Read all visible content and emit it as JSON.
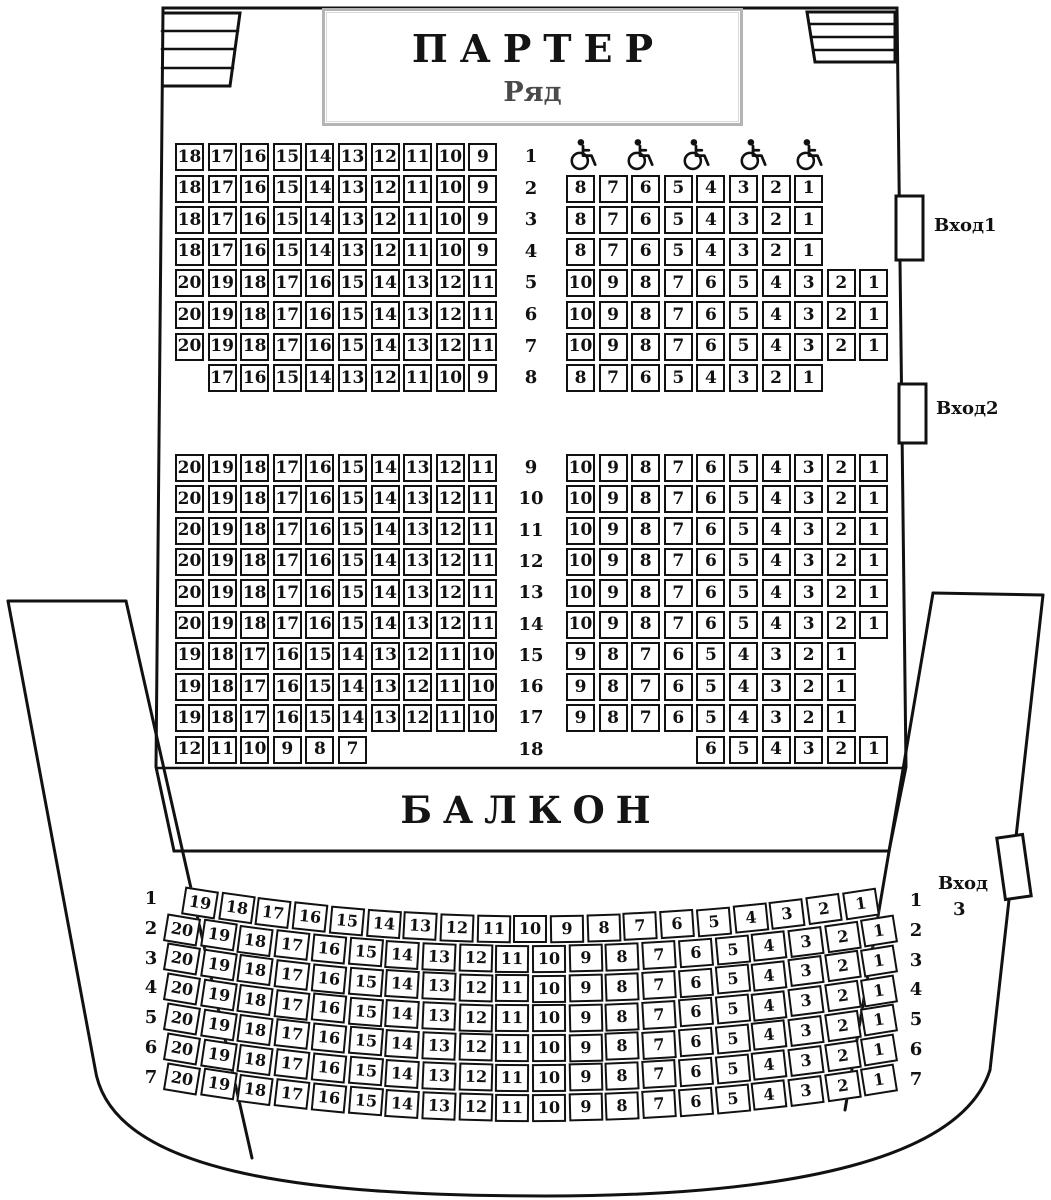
{
  "parterre": {
    "title": "ПАРТЕР",
    "subtitle": "Ряд",
    "rows": [
      {
        "n": "1",
        "left": [
          18,
          17,
          16,
          15,
          14,
          13,
          12,
          11,
          10,
          9
        ],
        "leftStart": 0,
        "wheelchairs": 5
      },
      {
        "n": "2",
        "left": [
          18,
          17,
          16,
          15,
          14,
          13,
          12,
          11,
          10,
          9
        ],
        "leftStart": 0,
        "right": [
          8,
          7,
          6,
          5,
          4,
          3,
          2,
          1
        ],
        "rightStart": 0
      },
      {
        "n": "3",
        "left": [
          18,
          17,
          16,
          15,
          14,
          13,
          12,
          11,
          10,
          9
        ],
        "leftStart": 0,
        "right": [
          8,
          7,
          6,
          5,
          4,
          3,
          2,
          1
        ],
        "rightStart": 0
      },
      {
        "n": "4",
        "left": [
          18,
          17,
          16,
          15,
          14,
          13,
          12,
          11,
          10,
          9
        ],
        "leftStart": 0,
        "right": [
          8,
          7,
          6,
          5,
          4,
          3,
          2,
          1
        ],
        "rightStart": 0
      },
      {
        "n": "5",
        "left": [
          20,
          19,
          18,
          17,
          16,
          15,
          14,
          13,
          12,
          11
        ],
        "leftStart": 0,
        "right": [
          10,
          9,
          8,
          7,
          6,
          5,
          4,
          3,
          2,
          1
        ],
        "rightStart": 0
      },
      {
        "n": "6",
        "left": [
          20,
          19,
          18,
          17,
          16,
          15,
          14,
          13,
          12,
          11
        ],
        "leftStart": 0,
        "right": [
          10,
          9,
          8,
          7,
          6,
          5,
          4,
          3,
          2,
          1
        ],
        "rightStart": 0
      },
      {
        "n": "7",
        "left": [
          20,
          19,
          18,
          17,
          16,
          15,
          14,
          13,
          12,
          11
        ],
        "leftStart": 0,
        "right": [
          10,
          9,
          8,
          7,
          6,
          5,
          4,
          3,
          2,
          1
        ],
        "rightStart": 0
      },
      {
        "n": "8",
        "left": [
          17,
          16,
          15,
          14,
          13,
          12,
          11,
          10,
          9
        ],
        "leftStart": 1,
        "right": [
          8,
          7,
          6,
          5,
          4,
          3,
          2,
          1
        ],
        "rightStart": 0
      },
      {
        "n": "9",
        "left": [
          20,
          19,
          18,
          17,
          16,
          15,
          14,
          13,
          12,
          11
        ],
        "leftStart": 0,
        "right": [
          10,
          9,
          8,
          7,
          6,
          5,
          4,
          3,
          2,
          1
        ],
        "rightStart": 0
      },
      {
        "n": "10",
        "left": [
          20,
          19,
          18,
          17,
          16,
          15,
          14,
          13,
          12,
          11
        ],
        "leftStart": 0,
        "right": [
          10,
          9,
          8,
          7,
          6,
          5,
          4,
          3,
          2,
          1
        ],
        "rightStart": 0
      },
      {
        "n": "11",
        "left": [
          20,
          19,
          18,
          17,
          16,
          15,
          14,
          13,
          12,
          11
        ],
        "leftStart": 0,
        "right": [
          10,
          9,
          8,
          7,
          6,
          5,
          4,
          3,
          2,
          1
        ],
        "rightStart": 0
      },
      {
        "n": "12",
        "left": [
          20,
          19,
          18,
          17,
          16,
          15,
          14,
          13,
          12,
          11
        ],
        "leftStart": 0,
        "right": [
          10,
          9,
          8,
          7,
          6,
          5,
          4,
          3,
          2,
          1
        ],
        "rightStart": 0
      },
      {
        "n": "13",
        "left": [
          20,
          19,
          18,
          17,
          16,
          15,
          14,
          13,
          12,
          11
        ],
        "leftStart": 0,
        "right": [
          10,
          9,
          8,
          7,
          6,
          5,
          4,
          3,
          2,
          1
        ],
        "rightStart": 0
      },
      {
        "n": "14",
        "left": [
          20,
          19,
          18,
          17,
          16,
          15,
          14,
          13,
          12,
          11
        ],
        "leftStart": 0,
        "right": [
          10,
          9,
          8,
          7,
          6,
          5,
          4,
          3,
          2,
          1
        ],
        "rightStart": 0
      },
      {
        "n": "15",
        "left": [
          19,
          18,
          17,
          16,
          15,
          14,
          13,
          12,
          11,
          10
        ],
        "leftStart": 0,
        "right": [
          9,
          8,
          7,
          6,
          5,
          4,
          3,
          2,
          1
        ],
        "rightStart": 0
      },
      {
        "n": "16",
        "left": [
          19,
          18,
          17,
          16,
          15,
          14,
          13,
          12,
          11,
          10
        ],
        "leftStart": 0,
        "right": [
          9,
          8,
          7,
          6,
          5,
          4,
          3,
          2,
          1
        ],
        "rightStart": 0
      },
      {
        "n": "17",
        "left": [
          19,
          18,
          17,
          16,
          15,
          14,
          13,
          12,
          11,
          10
        ],
        "leftStart": 0,
        "right": [
          9,
          8,
          7,
          6,
          5,
          4,
          3,
          2,
          1
        ],
        "rightStart": 0
      },
      {
        "n": "18",
        "left": [
          12,
          11,
          10,
          9,
          8,
          7
        ],
        "leftStart": 0,
        "right": [
          6,
          5,
          4,
          3,
          2,
          1
        ],
        "rightStart": 4
      }
    ]
  },
  "balcony": {
    "title": "БАЛКОН",
    "rows": [
      {
        "n": "1",
        "seats": [
          19,
          18,
          17,
          16,
          15,
          14,
          13,
          12,
          11,
          10,
          9,
          8,
          7,
          6,
          5,
          4,
          3,
          2,
          1
        ]
      },
      {
        "n": "2",
        "seats": [
          20,
          19,
          18,
          17,
          16,
          15,
          14,
          13,
          12,
          11,
          10,
          9,
          8,
          7,
          6,
          5,
          4,
          3,
          2,
          1
        ]
      },
      {
        "n": "3",
        "seats": [
          20,
          19,
          18,
          17,
          16,
          15,
          14,
          13,
          12,
          11,
          10,
          9,
          8,
          7,
          6,
          5,
          4,
          3,
          2,
          1
        ]
      },
      {
        "n": "4",
        "seats": [
          20,
          19,
          18,
          17,
          16,
          15,
          14,
          13,
          12,
          11,
          10,
          9,
          8,
          7,
          6,
          5,
          4,
          3,
          2,
          1
        ]
      },
      {
        "n": "5",
        "seats": [
          20,
          19,
          18,
          17,
          16,
          15,
          14,
          13,
          12,
          11,
          10,
          9,
          8,
          7,
          6,
          5,
          4,
          3,
          2,
          1
        ]
      },
      {
        "n": "6",
        "seats": [
          20,
          19,
          18,
          17,
          16,
          15,
          14,
          13,
          12,
          11,
          10,
          9,
          8,
          7,
          6,
          5,
          4,
          3,
          2,
          1
        ]
      },
      {
        "n": "7",
        "seats": [
          20,
          19,
          18,
          17,
          16,
          15,
          14,
          13,
          12,
          11,
          10,
          9,
          8,
          7,
          6,
          5,
          4,
          3,
          2,
          1
        ]
      }
    ]
  },
  "entrances": {
    "e1": "Вход1",
    "e2": "Вход2",
    "e3_line1": "Вход",
    "e3_line2": "3"
  },
  "colors": {
    "ink": "#111111",
    "title_box_border": "#b4b4b4",
    "subtitle_gray": "#4a4a4a"
  },
  "icons": {
    "wheelchair": "wheelchair-icon"
  }
}
